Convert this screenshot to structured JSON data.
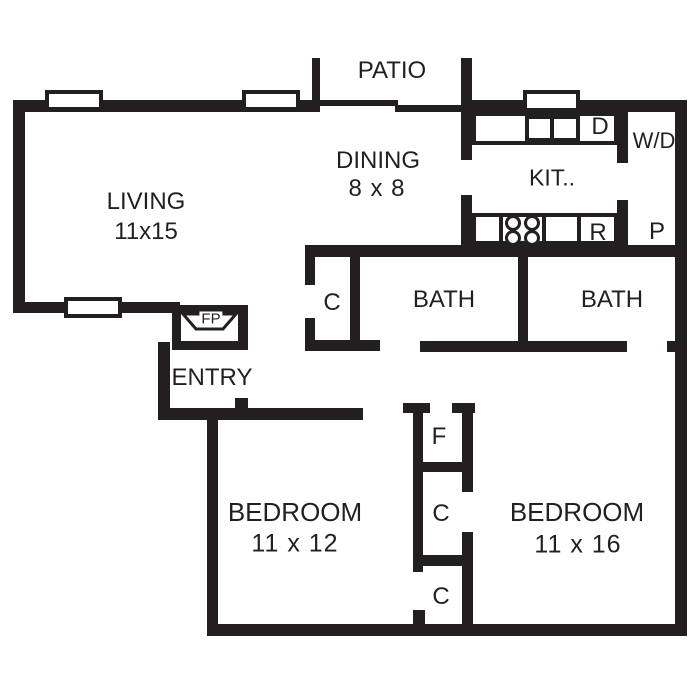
{
  "colors": {
    "wall": "#231f20",
    "floor": "#ffffff"
  },
  "rooms": {
    "patio": {
      "label": "PATIO"
    },
    "living": {
      "label": "LIVING",
      "dims": "11x15"
    },
    "dining": {
      "label": "DINING",
      "dims": "8 x 8"
    },
    "kitchen": {
      "label": "KIT.."
    },
    "bath_left": {
      "label": "BATH"
    },
    "bath_right": {
      "label": "BATH"
    },
    "entry": {
      "label": "ENTRY"
    },
    "bedroom_left": {
      "label": "BEDROOM",
      "dims": "11 x 12"
    },
    "bedroom_right": {
      "label": "BEDROOM",
      "dims": "11 x 16"
    }
  },
  "fixtures": {
    "dishwasher": {
      "label": "D"
    },
    "washer_dryer": {
      "label": "W/D"
    },
    "range": {
      "label": "R"
    },
    "pantry": {
      "label": "P"
    },
    "fireplace": {
      "label": "FP"
    },
    "furnace": {
      "label": "F"
    },
    "closet_hall": {
      "label": "C"
    },
    "closet_middle": {
      "label": "C"
    },
    "closet_lower": {
      "label": "C"
    }
  },
  "floorplan": {
    "rects": [
      {
        "name": "wall-living-top",
        "cls": "wall",
        "x": 13,
        "y": 100,
        "w": 307,
        "h": 12
      },
      {
        "name": "wall-living-left",
        "cls": "wall",
        "x": 13,
        "y": 100,
        "w": 12,
        "h": 213
      },
      {
        "name": "wall-living-bottom",
        "cls": "wall",
        "x": 13,
        "y": 302,
        "w": 167,
        "h": 11
      },
      {
        "name": "wall-patio-stub-left",
        "cls": "wall",
        "x": 312,
        "y": 58,
        "w": 8,
        "h": 54
      },
      {
        "name": "patio-door-panel-a",
        "cls": "wall",
        "x": 318,
        "y": 100,
        "w": 80,
        "h": 6
      },
      {
        "name": "patio-door-panel-b",
        "cls": "wall",
        "x": 395,
        "y": 105,
        "w": 68,
        "h": 7
      },
      {
        "name": "wall-dining-kitchen-upper",
        "cls": "wall",
        "x": 461,
        "y": 58,
        "w": 11,
        "h": 102
      },
      {
        "name": "wall-dining-kitchen-lower",
        "cls": "wall",
        "x": 461,
        "y": 195,
        "w": 11,
        "h": 62
      },
      {
        "name": "wall-kitchen-top",
        "cls": "wall",
        "x": 472,
        "y": 100,
        "w": 215,
        "h": 12
      },
      {
        "name": "wall-outer-right",
        "cls": "wall",
        "x": 675,
        "y": 100,
        "w": 12,
        "h": 536
      },
      {
        "name": "wall-wd-divider-upper",
        "cls": "wall",
        "x": 617,
        "y": 107,
        "w": 11,
        "h": 56
      },
      {
        "name": "wall-wd-divider-lower",
        "cls": "wall",
        "x": 617,
        "y": 200,
        "w": 11,
        "h": 57
      },
      {
        "name": "wall-kitchen-bottom",
        "cls": "wall",
        "x": 305,
        "y": 245,
        "w": 381,
        "h": 12
      },
      {
        "name": "wall-hall-closet-left-upper",
        "cls": "wall",
        "x": 305,
        "y": 257,
        "w": 10,
        "h": 28
      },
      {
        "name": "wall-hall-closet-left-lower",
        "cls": "wall",
        "x": 305,
        "y": 318,
        "w": 10,
        "h": 32
      },
      {
        "name": "wall-hall-closet-right",
        "cls": "wall",
        "x": 350,
        "y": 257,
        "w": 10,
        "h": 93
      },
      {
        "name": "wall-hall-closet-bottom",
        "cls": "wall",
        "x": 305,
        "y": 340,
        "w": 75,
        "h": 11
      },
      {
        "name": "wall-bath-divider",
        "cls": "wall",
        "x": 518,
        "y": 257,
        "w": 10,
        "h": 95
      },
      {
        "name": "wall-baths-bottom",
        "cls": "wall",
        "x": 420,
        "y": 341,
        "w": 207,
        "h": 11
      },
      {
        "name": "wall-right-notch",
        "cls": "wall",
        "x": 667,
        "y": 341,
        "w": 8,
        "h": 11
      },
      {
        "name": "wall-entry-left",
        "cls": "wall",
        "x": 158,
        "y": 342,
        "w": 12,
        "h": 78
      },
      {
        "name": "wall-entry-bottom",
        "cls": "wall",
        "x": 158,
        "y": 408,
        "w": 205,
        "h": 12
      },
      {
        "name": "entry-door-jamb",
        "cls": "wall",
        "x": 235,
        "y": 398,
        "w": 13,
        "h": 10
      },
      {
        "name": "wall-bedroom1-left",
        "cls": "wall",
        "x": 207,
        "y": 408,
        "w": 11,
        "h": 228
      },
      {
        "name": "wall-outer-bottom",
        "cls": "wall",
        "x": 207,
        "y": 624,
        "w": 480,
        "h": 12
      },
      {
        "name": "wall-furnace-cap-left",
        "cls": "wall",
        "x": 403,
        "y": 403,
        "w": 27,
        "h": 10
      },
      {
        "name": "wall-furnace-cap-right",
        "cls": "wall",
        "x": 452,
        "y": 403,
        "w": 23,
        "h": 10
      },
      {
        "name": "wall-closet-column-left",
        "cls": "wall",
        "x": 413,
        "y": 403,
        "w": 10,
        "h": 169
      },
      {
        "name": "wall-furnace-right",
        "cls": "wall",
        "x": 462,
        "y": 413,
        "w": 11,
        "h": 79
      },
      {
        "name": "wall-furnace-closet-divider",
        "cls": "wall",
        "x": 423,
        "y": 462,
        "w": 39,
        "h": 10
      },
      {
        "name": "wall-closet-divider",
        "cls": "wall",
        "x": 423,
        "y": 555,
        "w": 50,
        "h": 11
      },
      {
        "name": "wall-closet-column-right-lower",
        "cls": "wall",
        "x": 462,
        "y": 532,
        "w": 11,
        "h": 92
      },
      {
        "name": "wall-closet-lower-stub",
        "cls": "wall",
        "x": 413,
        "y": 610,
        "w": 12,
        "h": 14
      },
      {
        "name": "fireplace-box",
        "cls": "wall",
        "x": 172,
        "y": 305,
        "w": 76,
        "h": 45
      },
      {
        "name": "fireplace-inner",
        "cls": "white",
        "x": 181,
        "y": 313,
        "w": 57,
        "h": 28
      },
      {
        "name": "window",
        "cls": "win",
        "x": 45,
        "y": 90,
        "w": 58,
        "h": 21
      },
      {
        "name": "window",
        "cls": "win",
        "x": 242,
        "y": 90,
        "w": 58,
        "h": 21
      },
      {
        "name": "window",
        "cls": "win",
        "x": 523,
        "y": 90,
        "w": 57,
        "h": 22
      },
      {
        "name": "window",
        "cls": "win",
        "x": 64,
        "y": 297,
        "w": 58,
        "h": 21
      },
      {
        "name": "kitchen-counter-top",
        "cls": "win",
        "x": 472,
        "y": 112,
        "w": 146,
        "h": 33
      },
      {
        "name": "kitchen-counter-bottom",
        "cls": "win",
        "x": 472,
        "y": 213,
        "w": 146,
        "h": 32
      },
      {
        "name": "sink",
        "cls": "win",
        "x": 525,
        "y": 115,
        "w": 55,
        "h": 27
      },
      {
        "name": "sink-divider",
        "cls": "wall",
        "x": 550,
        "y": 115,
        "w": 4,
        "h": 27
      },
      {
        "name": "stove",
        "cls": "win",
        "x": 499,
        "y": 213,
        "w": 47,
        "h": 32
      },
      {
        "name": "counter-divider",
        "cls": "wall",
        "x": 577,
        "y": 213,
        "w": 4,
        "h": 32
      }
    ],
    "circles": [
      {
        "name": "stove-burner",
        "cx": 513,
        "cy": 223,
        "r": 8
      },
      {
        "name": "stove-burner",
        "cx": 532,
        "cy": 223,
        "r": 8
      },
      {
        "name": "stove-burner",
        "cx": 513,
        "cy": 238,
        "r": 8
      },
      {
        "name": "stove-burner",
        "cx": 532,
        "cy": 238,
        "r": 8
      }
    ]
  }
}
